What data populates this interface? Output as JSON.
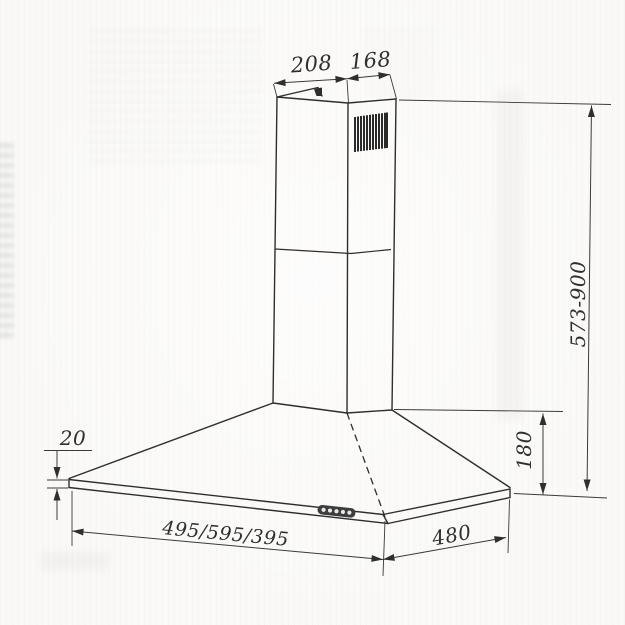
{
  "drawing": {
    "dims": {
      "chimney_front_width": "208",
      "chimney_side_depth": "168",
      "height_adjustable": "573-900",
      "canopy_height": "180",
      "rim_height": "20",
      "width_options": "495/595/395",
      "depth": "480"
    }
  }
}
